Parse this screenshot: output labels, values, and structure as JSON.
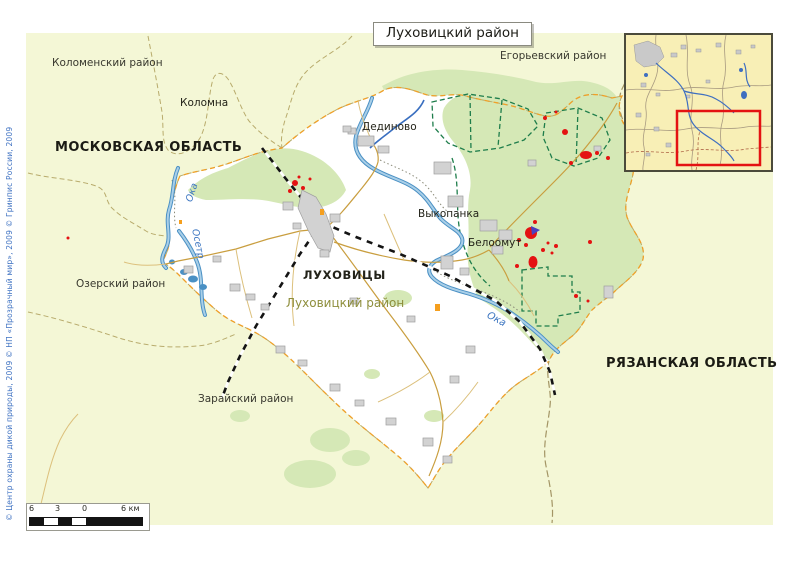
{
  "title": "Луховицкий район",
  "copyright": "© Центр охраны дикой природы, 2009 © НП «Прозрачный мир», 2009 © Гринпис России, 2009",
  "map": {
    "oblast_labels": {
      "moscow": "МОСКОВСКАЯ ОБЛАСТЬ",
      "ryazan": "РЯЗАНСКАЯ ОБЛАСТЬ"
    },
    "district_labels": {
      "kolomensky": "Коломенский район",
      "egoryevsky": "Егорьевский район",
      "ozersky": "Озерский район",
      "zaraysky": "Зарайский район",
      "lukhovitsky": "Луховицкий район"
    },
    "settlement_labels": {
      "kolomna": "Коломна",
      "lukhovitsy": "ЛУХОВИЦЫ",
      "dedinovo": "Дединово",
      "vykopanka": "Выкопанка",
      "beloomut": "Белоомут"
    },
    "river_labels": {
      "oka_west": "Ока",
      "osetr": "Осетр",
      "oka_east": "Ока"
    }
  },
  "scale_bar": {
    "tick_6_left": "6",
    "tick_3": "3",
    "tick_0": "0",
    "tick_6_right": "6 км"
  },
  "colors": {
    "map_background": "#f4f7d6",
    "district_fill": "#ffffff",
    "forest_green": "#d5e8b6",
    "water_blue": "#4a90c4",
    "settlement_gray": "#d2d2d2",
    "road_tan": "#c99e3f",
    "railway_black": "#141414",
    "district_boundary_orange": "#f0a028",
    "admin_boundary_olive": "#b8ab6c",
    "protected_green": "#1e7d4b",
    "burn_red": "#e41212",
    "inset_background": "#f8efb6",
    "highlight_rect_red": "#e41212",
    "copyright_blue": "#3f72c2"
  }
}
